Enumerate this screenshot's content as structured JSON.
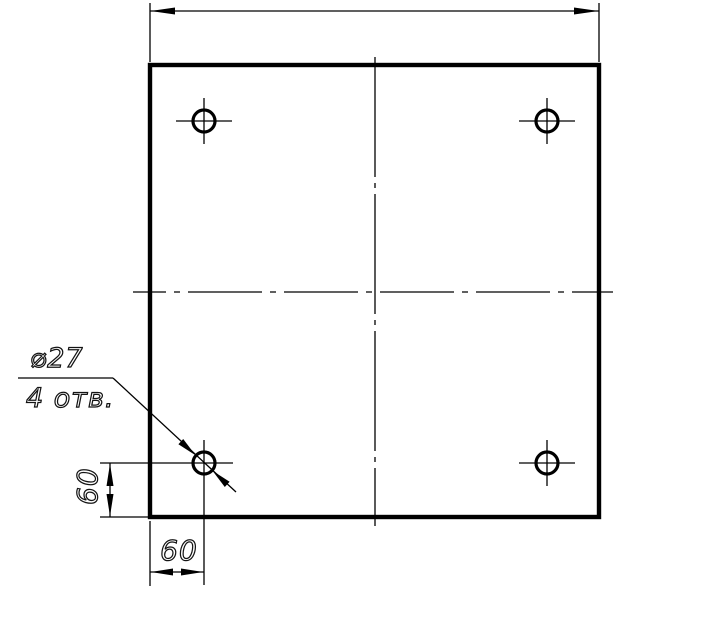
{
  "page": {
    "background_color": "#ffffff",
    "line_color": "#000000",
    "description": "Engineering drawing: square plate, front view, four drilled holes with hole callout and offset dimensions"
  },
  "drawing": {
    "hole_callout": {
      "line1": "⌀27",
      "line2": "4 отв."
    },
    "dimensions": {
      "overall_width_label": "",
      "hole_offset_from_bottom": "60",
      "hole_offset_from_left": "60"
    },
    "icons": {
      "arrowhead": "filled dart triangle (dimension arrow)",
      "center_mark": "thin cross through hole center",
      "centerline": "dash-dot line"
    }
  }
}
